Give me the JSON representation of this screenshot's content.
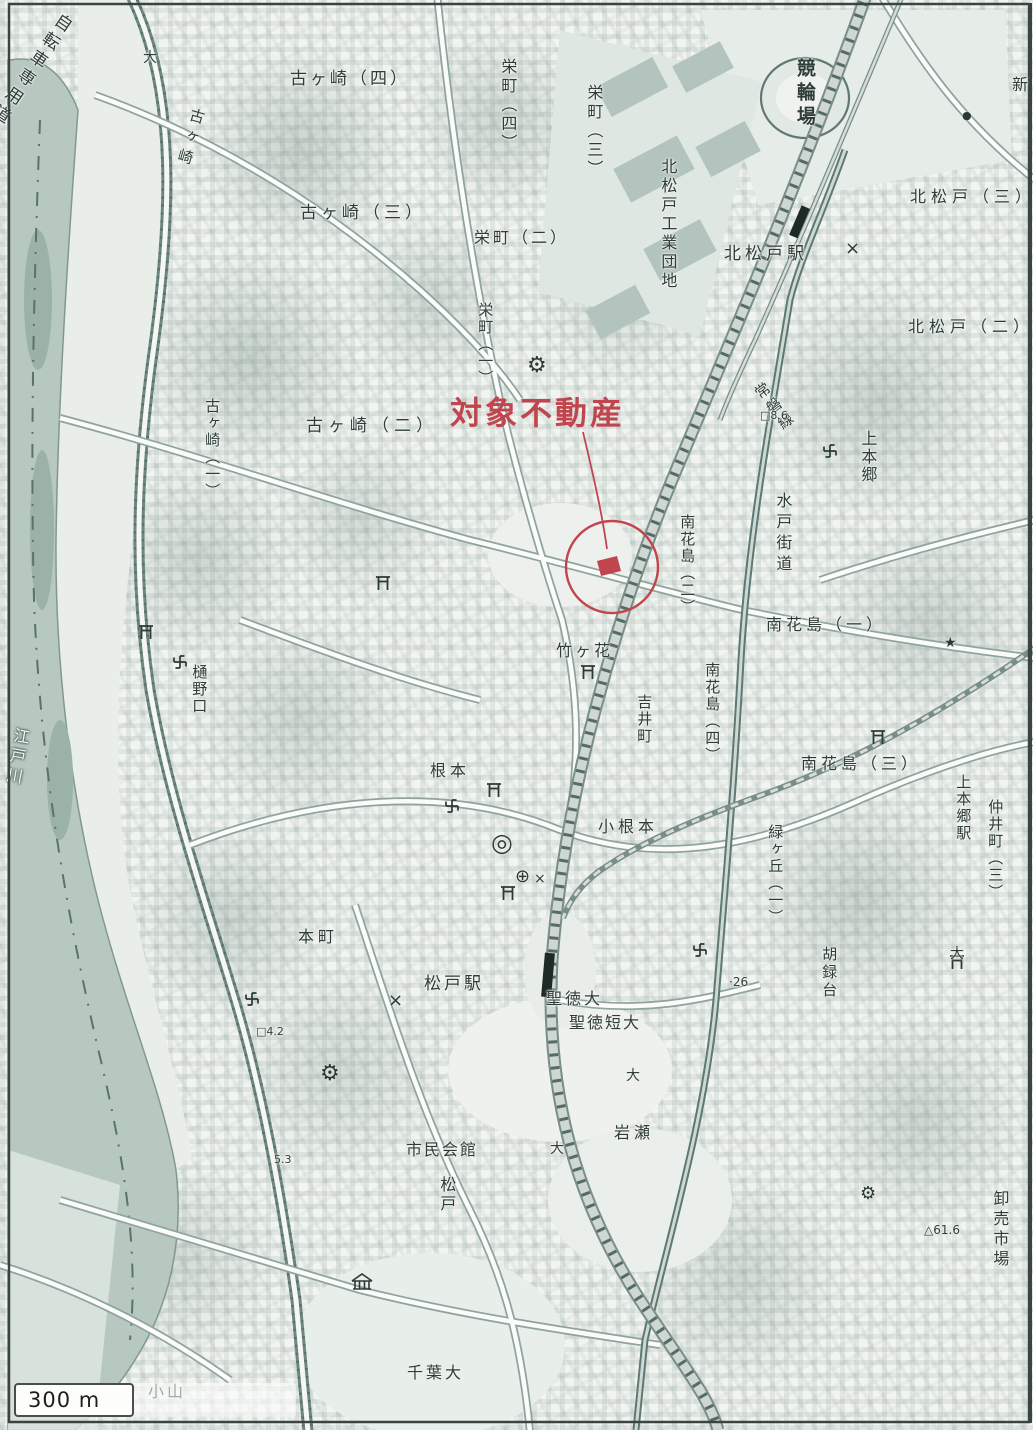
{
  "map": {
    "annotation": {
      "label": "対象不動産"
    },
    "scale_bar": {
      "label": "300 m"
    },
    "colors": {
      "annotation": "#c0454e",
      "river": "#b7c8c1",
      "paper": "#f2f4f0",
      "ink": "#2e3d39"
    },
    "labels": [
      {
        "id": "bicycle-road",
        "text": "自転車専用道路",
        "x": 58,
        "y": 8,
        "v": true,
        "rot": 34,
        "size": 17,
        "sp": 5
      },
      {
        "id": "kogasaki",
        "text": "古ヶ崎",
        "x": 190,
        "y": 106,
        "v": true,
        "rot": 16,
        "size": 15,
        "sp": 6
      },
      {
        "id": "kogasaki-4",
        "text": "古ヶ崎（四）",
        "x": 290,
        "y": 70,
        "size": 17,
        "sp": 3
      },
      {
        "id": "sakaecho-4",
        "text": "栄町（四）",
        "x": 498,
        "y": 58,
        "v": true,
        "size": 16,
        "sp": 3
      },
      {
        "id": "sakaecho-3",
        "text": "栄町（三）",
        "x": 584,
        "y": 84,
        "v": true,
        "size": 16,
        "sp": 3
      },
      {
        "id": "kogasaki-3",
        "text": "古ヶ崎（三）",
        "x": 300,
        "y": 204,
        "size": 17,
        "sp": 4
      },
      {
        "id": "sakaecho-2",
        "text": "栄町（二）",
        "x": 474,
        "y": 229,
        "size": 16,
        "sp": 3
      },
      {
        "id": "sakaecho-1",
        "text": "栄町（一）",
        "x": 476,
        "y": 302,
        "v": true,
        "size": 15,
        "sp": 2
      },
      {
        "id": "kogasaki-2",
        "text": "古ヶ崎（二）",
        "x": 306,
        "y": 417,
        "size": 17,
        "sp": 5
      },
      {
        "id": "kogasaki-1",
        "text": "古ヶ崎（一）",
        "x": 203,
        "y": 398,
        "v": true,
        "size": 15,
        "sp": 2
      },
      {
        "id": "kitamatsudo-kogyo-danchi",
        "text": "北松戸工業団地",
        "x": 658,
        "y": 158,
        "v": true,
        "size": 16,
        "sp": 3
      },
      {
        "id": "keirinjo",
        "text": "競輪場",
        "x": 793,
        "y": 58,
        "v": true,
        "size": 19,
        "sp": 5,
        "w": 700
      },
      {
        "id": "kitamatsudo-station",
        "text": "北松戸駅",
        "x": 724,
        "y": 245,
        "size": 17,
        "sp": 4
      },
      {
        "id": "kitamatsudo-3",
        "text": "北松戸（三）",
        "x": 910,
        "y": 188,
        "size": 16,
        "sp": 5
      },
      {
        "id": "kitamatsudo-2",
        "text": "北松戸（二）",
        "x": 908,
        "y": 318,
        "size": 16,
        "sp": 5
      },
      {
        "id": "shin",
        "text": "新",
        "x": 1012,
        "y": 76,
        "size": 16
      },
      {
        "id": "joban-line",
        "text": "常磐線",
        "x": 750,
        "y": 390,
        "v": true,
        "rot": -37,
        "size": 15,
        "sp": 4
      },
      {
        "id": "mito-kaido",
        "text": "水戸街道",
        "x": 773,
        "y": 492,
        "v": true,
        "size": 16,
        "sp": 5
      },
      {
        "id": "kamihongo",
        "text": "上本郷",
        "x": 858,
        "y": 430,
        "v": true,
        "size": 16,
        "sp": 2
      },
      {
        "id": "minamihanajima-2",
        "text": "南花島（二）",
        "x": 678,
        "y": 514,
        "v": true,
        "size": 15,
        "sp": 2
      },
      {
        "id": "minamihanajima-4",
        "text": "南花島（四）",
        "x": 703,
        "y": 662,
        "v": true,
        "size": 15,
        "sp": 2
      },
      {
        "id": "minamihanajima-1",
        "text": "南花島（一）",
        "x": 766,
        "y": 616,
        "size": 16,
        "sp": 4
      },
      {
        "id": "minamihanajima-3",
        "text": "南花島（三）",
        "x": 801,
        "y": 755,
        "size": 16,
        "sp": 4
      },
      {
        "id": "takegahana",
        "text": "竹ヶ花",
        "x": 556,
        "y": 642,
        "size": 16,
        "sp": 3
      },
      {
        "id": "yoshiicho",
        "text": "吉井町",
        "x": 635,
        "y": 694,
        "v": true,
        "size": 15,
        "sp": 2
      },
      {
        "id": "nemoto",
        "text": "根本",
        "x": 430,
        "y": 762,
        "size": 16,
        "sp": 4
      },
      {
        "id": "hinoguchi",
        "text": "樋野口",
        "x": 190,
        "y": 664,
        "v": true,
        "size": 15,
        "sp": 2
      },
      {
        "id": "konemoto",
        "text": "小根本",
        "x": 598,
        "y": 818,
        "size": 16,
        "sp": 4
      },
      {
        "id": "midorigaoka-1",
        "text": "緑ヶ丘（一）",
        "x": 766,
        "y": 824,
        "v": true,
        "size": 15,
        "sp": 2
      },
      {
        "id": "kamihongo-station",
        "text": "上本郷駅",
        "x": 954,
        "y": 774,
        "v": true,
        "size": 15,
        "sp": 2
      },
      {
        "id": "nakaicho-3",
        "text": "仲井町（三）",
        "x": 986,
        "y": 799,
        "v": true,
        "size": 15,
        "sp": 2
      },
      {
        "id": "korokudai",
        "text": "胡録台",
        "x": 820,
        "y": 946,
        "v": true,
        "size": 15,
        "sp": 3
      },
      {
        "id": "honcho",
        "text": "本町",
        "x": 298,
        "y": 928,
        "size": 16,
        "sp": 4
      },
      {
        "id": "matsudo-station",
        "text": "松戸駅",
        "x": 424,
        "y": 975,
        "size": 17,
        "sp": 3
      },
      {
        "id": "seitoku-univ",
        "text": "聖徳大",
        "x": 546,
        "y": 990,
        "size": 16,
        "sp": 3
      },
      {
        "id": "seitoku-junior-college",
        "text": "聖徳短大",
        "x": 569,
        "y": 1014,
        "size": 16,
        "sp": 2
      },
      {
        "id": "iwase",
        "text": "岩瀬",
        "x": 614,
        "y": 1124,
        "size": 16,
        "sp": 4
      },
      {
        "id": "shimin-kaikan",
        "text": "市民会館",
        "x": 406,
        "y": 1141,
        "size": 16,
        "sp": 2
      },
      {
        "id": "matsudo-town",
        "text": "松戸",
        "x": 437,
        "y": 1176,
        "v": true,
        "size": 16,
        "sp": 3
      },
      {
        "id": "chiba-univ",
        "text": "千葉大",
        "x": 407,
        "y": 1364,
        "size": 16,
        "sp": 3
      },
      {
        "id": "koyama",
        "text": "小山",
        "x": 148,
        "y": 1383,
        "size": 16,
        "sp": 3
      },
      {
        "id": "oroshiuri-ichiba",
        "text": "卸売市場",
        "x": 990,
        "y": 1190,
        "v": true,
        "size": 16,
        "sp": 4
      },
      {
        "id": "edogawa",
        "text": "江戸川",
        "x": 12,
        "y": 726,
        "v": true,
        "rot": 10,
        "size": 16,
        "sp": 4,
        "color": "#f3f6f2",
        "shadow": "dark"
      },
      {
        "id": "spot-elev-61-6",
        "text": "△61.6",
        "x": 924,
        "y": 1224,
        "size": 12
      },
      {
        "id": "spot-elev-26",
        "text": "·26",
        "x": 729,
        "y": 976,
        "size": 12
      },
      {
        "id": "bench-elev-8-6",
        "text": "□8.6",
        "x": 760,
        "y": 410,
        "size": 11
      },
      {
        "id": "bench-elev-4-2",
        "text": "□4.2",
        "x": 256,
        "y": 1026,
        "size": 11
      },
      {
        "id": "spot-elev-5-3",
        "text": "5.3",
        "x": 274,
        "y": 1154,
        "size": 11
      },
      {
        "id": "dai-marker-1",
        "text": "大",
        "x": 143,
        "y": 50,
        "size": 14
      },
      {
        "id": "dai-marker-2",
        "text": "大",
        "x": 626,
        "y": 1068,
        "size": 14
      },
      {
        "id": "dai-marker-3",
        "text": "大",
        "x": 550,
        "y": 1141,
        "size": 14
      },
      {
        "id": "dai-marker-4",
        "text": "大",
        "x": 950,
        "y": 946,
        "size": 14
      }
    ],
    "symbols": [
      {
        "id": "police-x-kitamatsudo",
        "glyph": "×",
        "x": 845,
        "y": 240,
        "size": 18
      },
      {
        "id": "police-x-matsudo",
        "glyph": "×",
        "x": 388,
        "y": 992,
        "size": 18
      },
      {
        "id": "police-x-konemoto",
        "glyph": "×",
        "x": 534,
        "y": 872,
        "size": 14
      },
      {
        "id": "hospital-cross",
        "glyph": "⊕",
        "x": 515,
        "y": 868,
        "size": 18
      },
      {
        "id": "city-office",
        "glyph": "◎",
        "x": 491,
        "y": 830,
        "size": 25
      },
      {
        "id": "shrine-star",
        "glyph": "★",
        "x": 944,
        "y": 636,
        "size": 14
      },
      {
        "id": "factory-gear-1",
        "glyph": "⚙",
        "x": 527,
        "y": 355,
        "size": 22
      },
      {
        "id": "factory-gear-2",
        "glyph": "⚙",
        "x": 320,
        "y": 1063,
        "size": 22
      },
      {
        "id": "factory-gear-3",
        "glyph": "⚙",
        "x": 860,
        "y": 1185,
        "size": 18
      },
      {
        "id": "post-office-dot",
        "glyph": "●",
        "x": 962,
        "y": 110,
        "size": 11
      }
    ]
  }
}
